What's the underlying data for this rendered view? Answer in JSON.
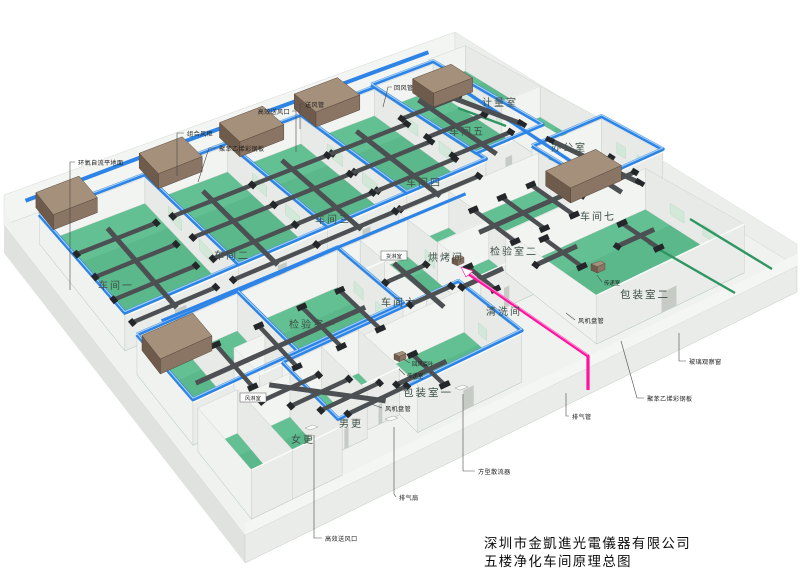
{
  "title": {
    "company": "深圳市金凱進光電儀器有限公司",
    "drawing": "五楼净化车间原理总图"
  },
  "rooms": {
    "workshop1": {
      "label": "车间一"
    },
    "workshop2": {
      "label": "车间二"
    },
    "workshop3": {
      "label": "车间三"
    },
    "workshop4": {
      "label": "车间四"
    },
    "workshop5": {
      "label": "车间五"
    },
    "workshop6": {
      "label": "车间六"
    },
    "workshop7": {
      "label": "车间七"
    },
    "metering": {
      "label": "计量室"
    },
    "office": {
      "label": "办公室"
    },
    "inspection1": {
      "label": "检验室一"
    },
    "inspection2": {
      "label": "检验室二"
    },
    "baking": {
      "label": "烘烤间"
    },
    "cleaning": {
      "label": "清洗间"
    },
    "packing1": {
      "label": "包装室一"
    },
    "packing2": {
      "label": "包装室二"
    },
    "cargo_shower": {
      "label": "货淋室"
    },
    "air_shower": {
      "label": "风淋室"
    },
    "female_changing": {
      "label": "女更"
    },
    "male_changing": {
      "label": "男更"
    }
  },
  "callouts": {
    "ahu": "组合风柜",
    "panel_top": "聚苯乙烯彩钢板",
    "epoxy_floor": "环氧自流平地面",
    "hepa_top": "高效送风口",
    "supply_duct": "送风管",
    "return_duct": "回风管",
    "glass_window": "玻璃观察窗",
    "panel_right": "聚苯乙烯彩钢板",
    "exhaust_pipe": "排气管",
    "fan_coil_right": "风机盘管",
    "fan_coil_bottom": "风机盘管",
    "pass_box_right": "传递室",
    "pass_box_bottom": "传递室",
    "return_louver": "回风百叶",
    "square_diffuser": "方型散流器",
    "exhaust_fan": "排气扇",
    "hepa_bottom": "高效送风口"
  },
  "colors": {
    "floor_green": "#5ab88b",
    "pipe_blue": "#2e84e6",
    "exhaust_pink": "#ff12a0",
    "duct_gray": "#4c5053",
    "ahu_brown": "#8a7463",
    "slab_white": "#f0f2ef"
  }
}
